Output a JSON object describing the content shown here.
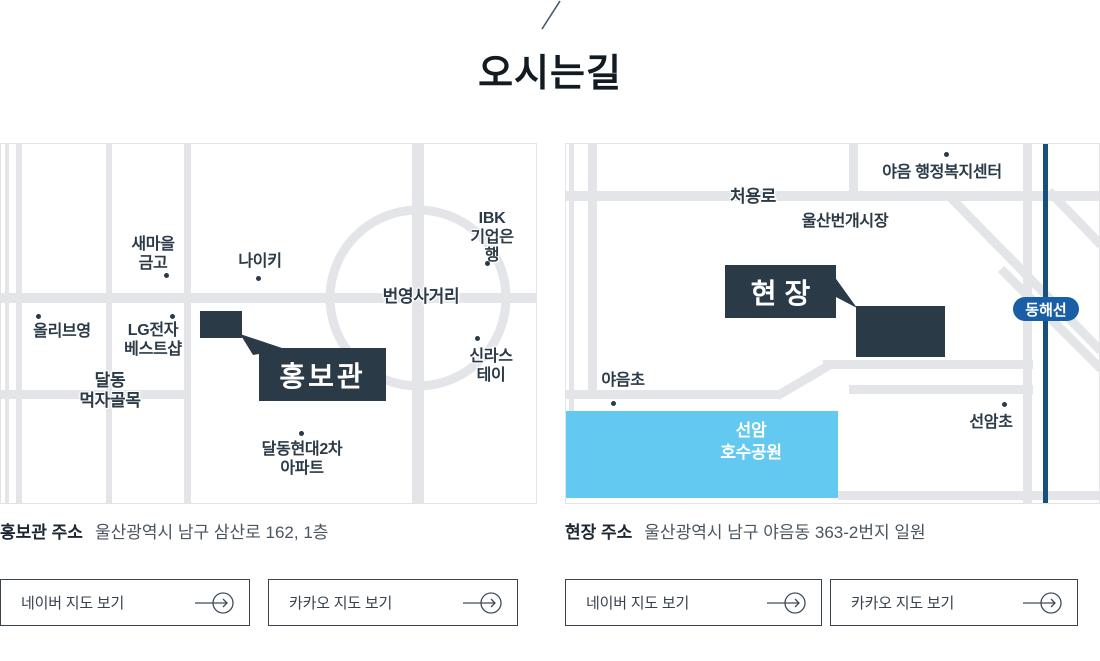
{
  "header": {
    "title": "오시는길"
  },
  "maps": {
    "left": {
      "marker": "홍보관",
      "landmarks": {
        "saemaeul": "새마을\n금고",
        "nike": "나이키",
        "oliveyoung": "올리브영",
        "lg": "LG전자\n베스트샵",
        "daldong_alley": "달동\n먹자골목",
        "ibk": "IBK\n기업은행",
        "intersection": "번영사거리",
        "shilla": "신라스테이",
        "apartment": "달동현대2차\n아파트"
      }
    },
    "right": {
      "marker": "현장",
      "landmarks": {
        "welfare_center": "야음 행정복지센터",
        "cheoyong_ro": "처용로",
        "market": "울산번개시장",
        "donghae_line": "동해선",
        "yaeum_elementary": "야음초",
        "seonam_elementary": "선암초",
        "lake_park": "선암\n호수공원"
      }
    }
  },
  "addresses": {
    "promo": {
      "label": "홍보관 주소",
      "value": "울산광역시 남구 삼산로 162, 1층"
    },
    "site": {
      "label": "현장 주소",
      "value": "울산광역시 남구 야음동 363-2번지 일원"
    }
  },
  "buttons": {
    "naver_label": "네이버 지도 보기",
    "kakao_label": "카카오 지도 보기"
  },
  "colors": {
    "accent_navy": "#2b3a47",
    "road_gray": "#e4e5e8",
    "park_blue": "#63c9f1",
    "rail_blue": "#1a5fa5"
  }
}
